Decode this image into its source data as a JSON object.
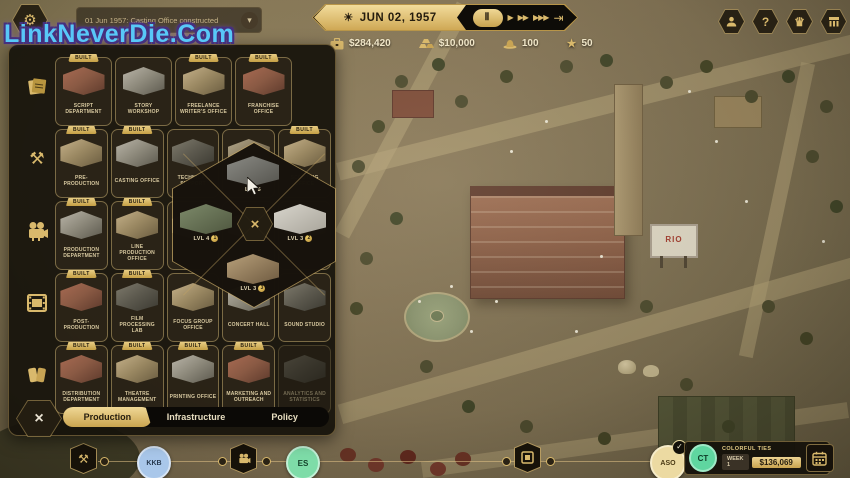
{
  "watermark": "LinkNeverDie.Com",
  "notification": {
    "text": "01 Jun 1957: Casting Office constructed"
  },
  "icons": {
    "gear": "⚙",
    "sun": "☀",
    "chevron_down": "▾",
    "question": "?",
    "crown": "♛",
    "pause": "Ⅱ",
    "play": "▶",
    "fast_forward": "▶▶",
    "fastest": "▶▶▶",
    "skip": "⇥",
    "tools": "⚒",
    "star": "★",
    "close": "×",
    "check": "✓"
  },
  "time_bar": {
    "date": "JUN 02, 1957"
  },
  "resources": [
    {
      "name": "cash",
      "value": "$284,420"
    },
    {
      "name": "gold",
      "value": "$10,000"
    },
    {
      "name": "influence",
      "value": "100"
    },
    {
      "name": "reputation",
      "value": "50"
    }
  ],
  "build_panel": {
    "categories": [
      "scripts",
      "production-prep",
      "filming",
      "post-production",
      "distribution"
    ],
    "rows": [
      {
        "items": [
          {
            "label": "SCRIPT DEPARTMENT",
            "badge": "BUILT"
          },
          {
            "label": "STORY WORKSHOP",
            "badge": ""
          },
          {
            "label": "FREELANCE WRITER'S OFFICE",
            "badge": "BUILT"
          },
          {
            "label": "FRANCHISE OFFICE",
            "badge": "BUILT"
          }
        ]
      },
      {
        "items": [
          {
            "label": "PRE-PRODUCTION",
            "badge": "BUILT"
          },
          {
            "label": "CASTING OFFICE",
            "badge": "BUILT"
          },
          {
            "label": "TECHNICAL SUPPORT",
            "badge": ""
          },
          {
            "label": "",
            "badge": ""
          },
          {
            "label": "SCOUTING OFFICE",
            "badge": "BUILT"
          }
        ]
      },
      {
        "items": [
          {
            "label": "PRODUCTION DEPARTMENT",
            "badge": "BUILT"
          },
          {
            "label": "LINE PRODUCTION OFFICE",
            "badge": "BUILT"
          },
          {
            "label": "",
            "badge": ""
          },
          {
            "label": "",
            "badge": ""
          },
          {
            "label": "",
            "badge": ""
          }
        ]
      },
      {
        "items": [
          {
            "label": "POST-PRODUCTION",
            "badge": "BUILT"
          },
          {
            "label": "FILM PROCESSING LAB",
            "badge": "BUILT"
          },
          {
            "label": "FOCUS GROUP OFFICE",
            "badge": ""
          },
          {
            "label": "CONCERT HALL",
            "badge": ""
          },
          {
            "label": "SOUND STUDIO",
            "badge": ""
          }
        ]
      },
      {
        "items": [
          {
            "label": "DISTRIBUTION DEPARTMENT",
            "badge": "BUILT"
          },
          {
            "label": "THEATRE MANAGEMENT",
            "badge": "BUILT"
          },
          {
            "label": "PRINTING OFFICE",
            "badge": "BUILT"
          },
          {
            "label": "MARKETING AND OUTREACH",
            "badge": "BUILT"
          },
          {
            "label": "ANALYTICS AND STATISTICS",
            "badge": ""
          }
        ]
      }
    ],
    "tabs": [
      {
        "label": "Production"
      },
      {
        "label": "Infrastructure"
      },
      {
        "label": "Policy"
      }
    ]
  },
  "upgrade_popup": {
    "options": [
      {
        "label": "LVL 5",
        "badge": ""
      },
      {
        "label": "LVL 4",
        "badge": "1"
      },
      {
        "label": "LVL 3",
        "badge": "2"
      },
      {
        "label": "LVL 3",
        "badge": "3"
      }
    ]
  },
  "bottom_bar": {
    "milestones": [
      {
        "code": "KKB"
      },
      {
        "code": "ES"
      },
      {
        "code": "ASO"
      },
      {
        "code": "CT"
      }
    ],
    "project": {
      "title": "COLORFUL TIES",
      "week": "WEEK 1",
      "budget": "$136,069"
    },
    "billboard_text": "RIO"
  },
  "colors": {
    "accent_gold": "#d9b96c",
    "milestone_kkb": "#a9c7ea",
    "milestone_es": "#7edca8",
    "milestone_aso": "#ecdaa2",
    "milestone_ct": "#5fd6a0",
    "watermark_blue": "#58c8f8"
  }
}
